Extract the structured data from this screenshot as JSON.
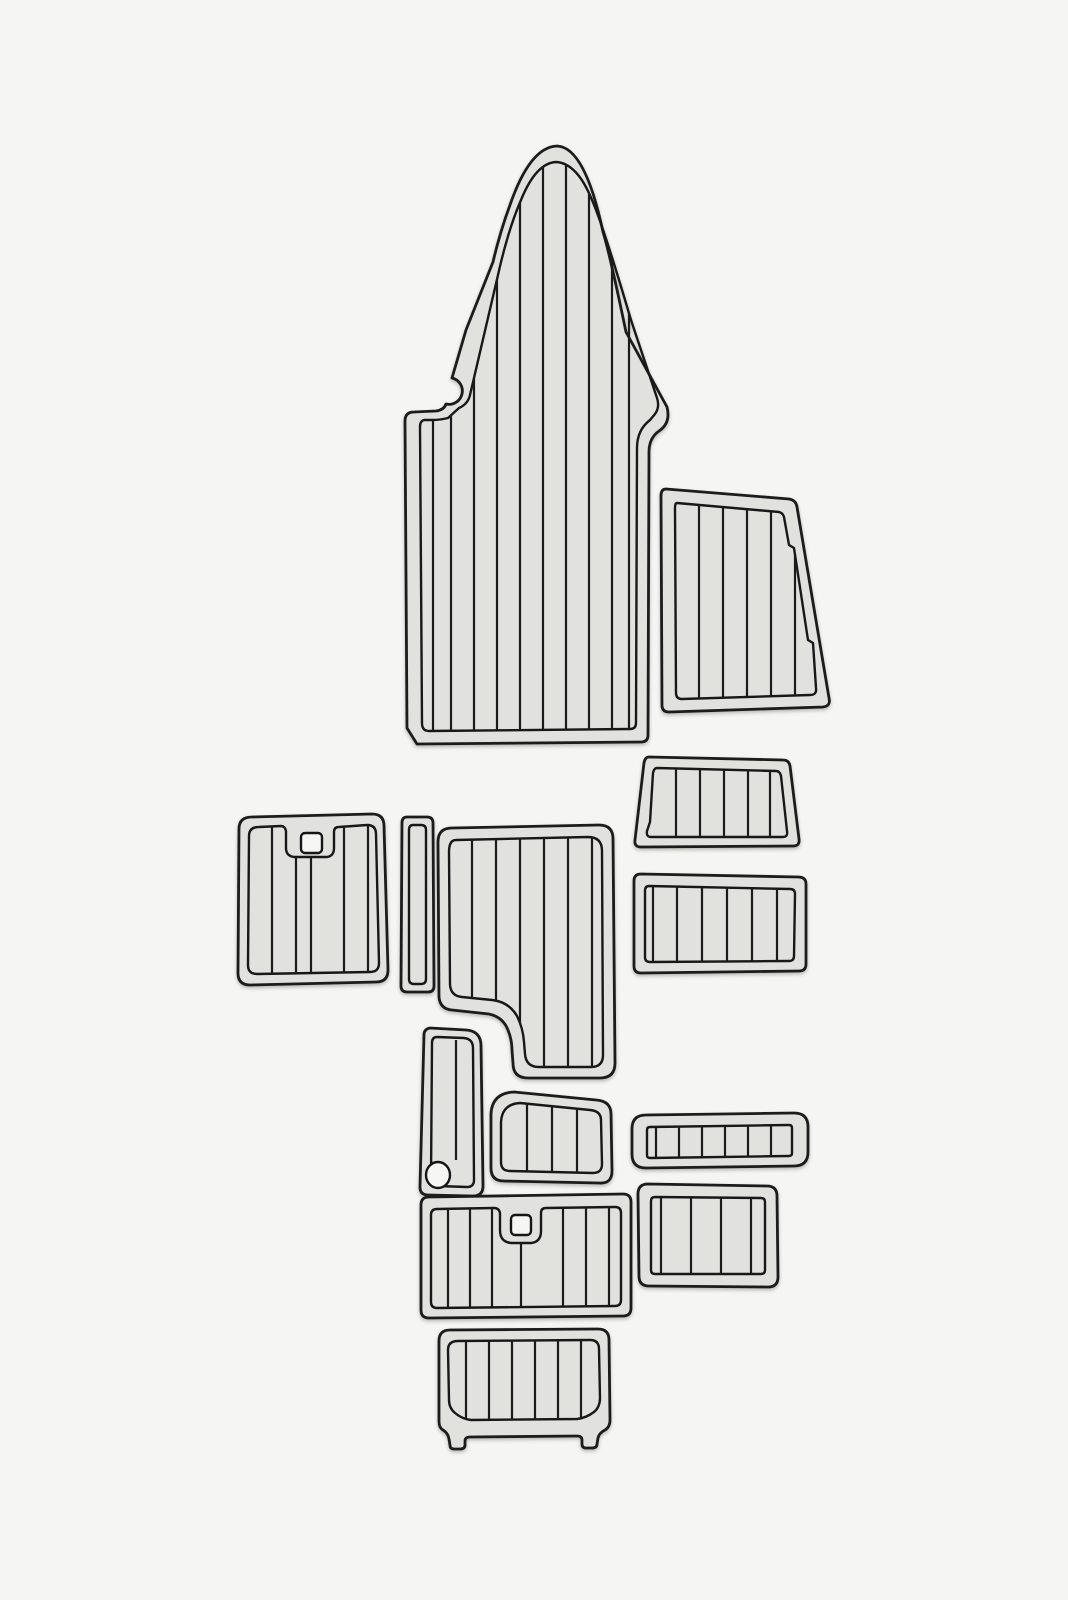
{
  "scene": {
    "type": "product-photo",
    "subject": "EVA foam faux-teak boat decking pad set laid out on a plain background",
    "piece_count": 13,
    "pieces": [
      {
        "name": "bow-pad",
        "shape": "bow / pointed dome with side notch"
      },
      {
        "name": "trapezoid-side-pad",
        "shape": "quadrilateral, slanted right edge"
      },
      {
        "name": "small-trapezoid-pad",
        "shape": "trapezoid, wider at bottom"
      },
      {
        "name": "hatch-pad-with-keyhole",
        "shape": "rounded rectangle with square latch cutout"
      },
      {
        "name": "narrow-vertical-strip",
        "shape": "thin rounded strip"
      },
      {
        "name": "cockpit-l-pad",
        "shape": "rectangle with concave bottom-left step"
      },
      {
        "name": "side-rectangle-pad-upper",
        "shape": "wide rounded rectangle"
      },
      {
        "name": "boot-shaped-pad",
        "shape": "narrow vertical pad with lower notch"
      },
      {
        "name": "small-rounded-pad",
        "shape": "small rectangle, large rounded top-left corner"
      },
      {
        "name": "step-tread-strip",
        "shape": "narrow horizontal strip with tread cells"
      },
      {
        "name": "side-rectangle-pad-lower",
        "shape": "rounded rectangle"
      },
      {
        "name": "transom-pad-with-keyhole",
        "shape": "wide rectangle with square latch cutout"
      },
      {
        "name": "swim-platform-pad",
        "shape": "rectangle with two bottom mounting feet"
      }
    ]
  },
  "colors": {
    "background": "#f5f5f3",
    "pad_rim": "#e1e1dd",
    "pad_field": "#d9d9d5",
    "hole": "#f6f6f4",
    "outline": "#1c1c1c"
  }
}
